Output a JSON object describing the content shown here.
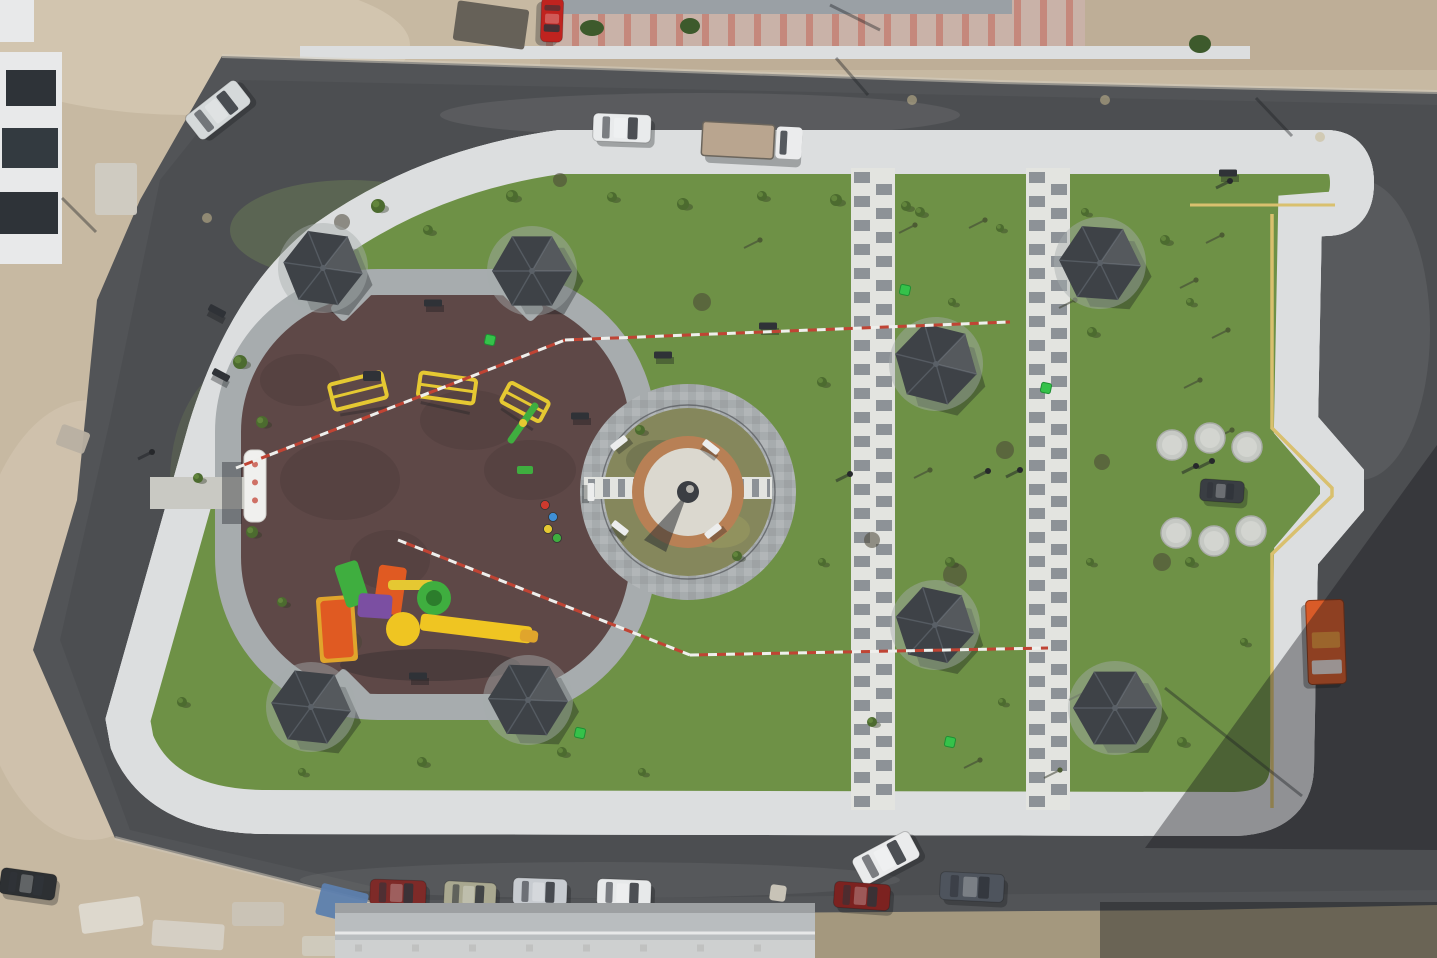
{
  "scene_title": "aerial-view-guitar-shaped-park",
  "palette": {
    "dirt": "#c7b9a2",
    "dirt_light": "#d9cdb8",
    "dirt_dark": "#b3a289",
    "scrub": "#b2a58b",
    "asphalt": "#525457",
    "asphalt_dark": "#434547",
    "asphalt_light": "#616365",
    "paver": "#a7acae",
    "paver_mid": "#96999c",
    "paver_light": "#c2c6c8",
    "kerb": "#dcdedf",
    "yellow_line": "#d9c06e",
    "grass": "#6e9146",
    "grass_dark": "#5a7c38",
    "grass_light": "#86a258",
    "grass_dry": "#9fa06b",
    "rubber": "#5e4847",
    "rubber_dark": "#4e3c3b",
    "neck_paver": "#83898d",
    "ladder_white": "#e3e4e0",
    "ladder_dark": "#8d9297",
    "gazebo_roof": "#3e4247",
    "gazebo_light": "#5a6067",
    "brick_ring": "#b88055",
    "plaza_white": "#dbd8cf",
    "ring_ground": "#85875c",
    "tape_red": "#c04434",
    "tape_white": "#efefec",
    "bin_green": "#35c24a",
    "concrete": "#c9c9c3",
    "eq_yellow": "#e5c832",
    "eq_green": "#3fae3f",
    "eq_orange": "#e05a22",
    "eq_purple": "#7b4fa2",
    "eq_red": "#cc3a2e",
    "eq_blue": "#3f8fd6",
    "truck_orange": "#d95b28"
  },
  "scene": {
    "gazebos": [
      {
        "x": 323,
        "y": 268,
        "r": 40,
        "rot": 8
      },
      {
        "x": 532,
        "y": 271,
        "r": 40,
        "rot": 0
      },
      {
        "x": 936,
        "y": 364,
        "r": 42,
        "rot": 14
      },
      {
        "x": 1100,
        "y": 263,
        "r": 41,
        "rot": 4
      },
      {
        "x": 311,
        "y": 707,
        "r": 40,
        "rot": 6
      },
      {
        "x": 528,
        "y": 700,
        "r": 40,
        "rot": 2
      },
      {
        "x": 935,
        "y": 625,
        "r": 40,
        "rot": 12
      },
      {
        "x": 1115,
        "y": 708,
        "r": 42,
        "rot": 0
      }
    ],
    "cars": [
      {
        "x": 218,
        "y": 110,
        "rot": -38,
        "w": 64,
        "h": 30,
        "c": "#d5d9da",
        "name": "silver-car-top-left"
      },
      {
        "x": 622,
        "y": 128,
        "rot": 2,
        "w": 58,
        "h": 28,
        "c": "#e9ebec",
        "name": "white-car-top-road"
      },
      {
        "x": 552,
        "y": 20,
        "rot": 92,
        "w": 44,
        "h": 22,
        "c": "#c0231f",
        "name": "red-car-building-lot"
      },
      {
        "x": 398,
        "y": 893,
        "rot": 2,
        "w": 56,
        "h": 26,
        "c": "#7e2a28",
        "name": "dark-red-car-bottom"
      },
      {
        "x": 470,
        "y": 895,
        "rot": 3,
        "w": 52,
        "h": 26,
        "c": "#a9a890",
        "name": "olive-car-bottom"
      },
      {
        "x": 540,
        "y": 892,
        "rot": 2,
        "w": 54,
        "h": 27,
        "c": "#c7cbd0",
        "name": "silver-car-bottom"
      },
      {
        "x": 624,
        "y": 893,
        "rot": 2,
        "w": 54,
        "h": 27,
        "c": "#e7e9ea",
        "name": "white-car-bottom"
      },
      {
        "x": 886,
        "y": 858,
        "rot": -28,
        "w": 64,
        "h": 30,
        "c": "#eaebec",
        "name": "white-van-bottom"
      },
      {
        "x": 862,
        "y": 896,
        "rot": 4,
        "w": 56,
        "h": 26,
        "c": "#7c2220",
        "name": "dark-red-car-bottom-2"
      },
      {
        "x": 972,
        "y": 887,
        "rot": 3,
        "w": 64,
        "h": 28,
        "c": "#4e545d",
        "name": "gray-suv-bottom"
      },
      {
        "x": 28,
        "y": 884,
        "rot": 8,
        "w": 56,
        "h": 26,
        "c": "#2d3033",
        "name": "black-car-bottom-left"
      },
      {
        "x": 1222,
        "y": 491,
        "rot": 4,
        "w": 44,
        "h": 22,
        "c": "#3a3e43",
        "name": "utility-cart-on-path"
      }
    ],
    "flatbed_truck": {
      "x": 752,
      "y": 141,
      "rot": 3,
      "bed": "#b9a58f",
      "cab": "#ebeced"
    },
    "orange_truck": {
      "x": 1326,
      "y": 642,
      "rot": 88,
      "w": 84,
      "h": 38
    },
    "people": [
      {
        "x": 1020,
        "y": 470
      },
      {
        "x": 1196,
        "y": 466
      },
      {
        "x": 1212,
        "y": 461
      },
      {
        "x": 850,
        "y": 474
      },
      {
        "x": 988,
        "y": 471
      },
      {
        "x": 152,
        "y": 452
      },
      {
        "x": 1230,
        "y": 181
      }
    ],
    "white_benches": [
      {
        "x": 619,
        "y": 443,
        "rot": -38
      },
      {
        "x": 711,
        "y": 447,
        "rot": 38
      },
      {
        "x": 620,
        "y": 528,
        "rot": 38
      },
      {
        "x": 713,
        "y": 531,
        "rot": -38
      },
      {
        "x": 591,
        "y": 492,
        "rot": 90
      }
    ],
    "dark_benches": [
      {
        "x": 433,
        "y": 303,
        "rot": 0
      },
      {
        "x": 217,
        "y": 311,
        "rot": 28
      },
      {
        "x": 221,
        "y": 375,
        "rot": 28
      },
      {
        "x": 418,
        "y": 676,
        "rot": 0
      },
      {
        "x": 1228,
        "y": 173,
        "rot": 0
      },
      {
        "x": 580,
        "y": 416,
        "rot": 0
      },
      {
        "x": 663,
        "y": 355,
        "rot": 0
      },
      {
        "x": 768,
        "y": 326,
        "rot": 0
      }
    ],
    "shrubs": [
      [
        378,
        206,
        7
      ],
      [
        428,
        230,
        5
      ],
      [
        512,
        196,
        6
      ],
      [
        612,
        197,
        5
      ],
      [
        683,
        204,
        6
      ],
      [
        762,
        196,
        5
      ],
      [
        836,
        200,
        6
      ],
      [
        906,
        206,
        5
      ],
      [
        240,
        362,
        7
      ],
      [
        262,
        422,
        6
      ],
      [
        252,
        532,
        6
      ],
      [
        282,
        602,
        5
      ],
      [
        198,
        478,
        5
      ],
      [
        920,
        212,
        5
      ],
      [
        1000,
        228,
        4
      ],
      [
        1085,
        212,
        4
      ],
      [
        1165,
        240,
        5
      ],
      [
        822,
        382,
        5
      ],
      [
        952,
        302,
        4
      ],
      [
        1092,
        332,
        5
      ],
      [
        1190,
        302,
        4
      ],
      [
        822,
        562,
        4
      ],
      [
        950,
        562,
        5
      ],
      [
        1090,
        562,
        4
      ],
      [
        1190,
        562,
        5
      ],
      [
        872,
        722,
        5
      ],
      [
        1002,
        702,
        4
      ],
      [
        1182,
        742,
        5
      ],
      [
        1244,
        642,
        4
      ],
      [
        562,
        752,
        5
      ],
      [
        642,
        772,
        4
      ],
      [
        422,
        762,
        5
      ],
      [
        302,
        772,
        4
      ],
      [
        182,
        702,
        5
      ],
      [
        640,
        430,
        5
      ],
      [
        737,
        556,
        5
      ]
    ],
    "saplings": [
      [
        915,
        225
      ],
      [
        985,
        220
      ],
      [
        1075,
        300
      ],
      [
        1222,
        235
      ],
      [
        1196,
        280
      ],
      [
        1228,
        330
      ],
      [
        1200,
        380
      ],
      [
        1232,
        430
      ],
      [
        760,
        240
      ],
      [
        930,
        470
      ],
      [
        1085,
        692
      ],
      [
        1135,
        695
      ],
      [
        980,
        760
      ],
      [
        1060,
        770
      ]
    ],
    "dry_patches": [
      [
        300,
        650,
        44,
        18
      ],
      [
        432,
        742,
        52,
        16
      ],
      [
        560,
        622,
        38,
        14
      ],
      [
        660,
        252,
        46,
        16
      ],
      [
        520,
        222,
        42,
        14
      ],
      [
        952,
        582,
        32,
        12
      ],
      [
        1082,
        642,
        38,
        12
      ],
      [
        882,
        702,
        32,
        12
      ],
      [
        350,
        250,
        36,
        12
      ],
      [
        760,
        600,
        40,
        14
      ],
      [
        1140,
        600,
        30,
        12
      ],
      [
        980,
        400,
        36,
        12
      ]
    ],
    "dark_patches": [
      [
        955,
        575,
        12
      ],
      [
        1005,
        450,
        9
      ],
      [
        872,
        540,
        8
      ],
      [
        702,
        302,
        9
      ],
      [
        352,
        642,
        10
      ],
      [
        1162,
        562,
        9
      ],
      [
        1102,
        462,
        8
      ],
      [
        342,
        222,
        8
      ],
      [
        560,
        180,
        7
      ]
    ],
    "grass_tones": [
      [
        430,
        620,
        130,
        60,
        "#5a7c38",
        0.22
      ],
      [
        350,
        230,
        120,
        50,
        "#86a258",
        0.28
      ],
      [
        900,
        600,
        160,
        70,
        "#5a7c38",
        0.18
      ],
      [
        1050,
        250,
        140,
        60,
        "#86a258",
        0.2
      ],
      [
        700,
        700,
        150,
        60,
        "#9fa06b",
        0.22
      ],
      [
        250,
        480,
        80,
        120,
        "#86a258",
        0.18
      ],
      [
        1150,
        480,
        60,
        100,
        "#9fa06b",
        0.18
      ],
      [
        600,
        200,
        140,
        40,
        "#9fa06b",
        0.18
      ]
    ],
    "rubber_blotches": [
      [
        340,
        480,
        60,
        40
      ],
      [
        470,
        420,
        50,
        30
      ],
      [
        390,
        560,
        40,
        30
      ],
      [
        300,
        380,
        40,
        26
      ],
      [
        530,
        470,
        46,
        30
      ]
    ],
    "bins": [
      [
        490,
        340
      ],
      [
        905,
        290
      ],
      [
        1046,
        388
      ],
      [
        580,
        733
      ],
      [
        950,
        742
      ]
    ],
    "discs": [
      [
        1172,
        445
      ],
      [
        1210,
        438
      ],
      [
        1247,
        447
      ],
      [
        1176,
        533
      ],
      [
        1214,
        541
      ],
      [
        1251,
        531
      ]
    ],
    "tapes": [
      [
        236,
        468,
        565,
        340
      ],
      [
        565,
        340,
        1010,
        322
      ],
      [
        398,
        540,
        690,
        655
      ],
      [
        690,
        655,
        1048,
        648
      ]
    ],
    "shadow_lines": [
      [
        868,
        95,
        836,
        58
      ],
      [
        1292,
        136,
        1256,
        98
      ],
      [
        1165,
        688,
        1302,
        796
      ],
      [
        96,
        232,
        62,
        198
      ],
      [
        880,
        30,
        830,
        5
      ]
    ],
    "road_dots": [
      [
        207,
        218
      ],
      [
        1105,
        100
      ],
      [
        1320,
        137
      ],
      [
        912,
        100
      ]
    ],
    "exercise_frames": [
      {
        "x": 358,
        "y": 391,
        "w": 54,
        "h": 26,
        "rot": -14
      },
      {
        "x": 447,
        "y": 388,
        "w": 56,
        "h": 24,
        "rot": 8
      },
      {
        "x": 525,
        "y": 402,
        "w": 44,
        "h": 22,
        "rot": 28
      }
    ],
    "seesaw": {
      "x": 523,
      "y": 423,
      "rot": -55
    },
    "green_bench": {
      "x": 525,
      "y": 470
    },
    "dark_mat": {
      "x": 372,
      "y": 376
    },
    "spring_riders": [
      [
        545,
        505,
        "#cc3a2e"
      ],
      [
        553,
        517,
        "#3f8fd6"
      ],
      [
        548,
        529,
        "#e5c832"
      ],
      [
        557,
        538,
        "#3fae3f"
      ]
    ],
    "play_structure": [
      {
        "t": "r",
        "x": 318,
        "y": 596,
        "w": 38,
        "h": 66,
        "rot": -4,
        "c": "#e0a52c"
      },
      {
        "t": "r",
        "x": 322,
        "y": 600,
        "w": 30,
        "h": 58,
        "rot": -4,
        "c": "#e05a22"
      },
      {
        "t": "r",
        "x": 340,
        "y": 562,
        "w": 24,
        "h": 44,
        "rot": -18,
        "c": "#3fae3f"
      },
      {
        "t": "r",
        "x": 376,
        "y": 566,
        "w": 28,
        "h": 48,
        "rot": 8,
        "c": "#e05a22"
      },
      {
        "t": "r",
        "x": 358,
        "y": 594,
        "w": 34,
        "h": 24,
        "rot": 4,
        "c": "#7b4fa2"
      },
      {
        "t": "r",
        "x": 388,
        "y": 580,
        "w": 46,
        "h": 10,
        "rot": 0,
        "c": "#e5c832"
      },
      {
        "t": "c",
        "x": 434,
        "y": 598,
        "r": 17,
        "c": "#3fae3f"
      },
      {
        "t": "c",
        "x": 434,
        "y": 598,
        "r": 8,
        "c": "#2c7d2c"
      },
      {
        "t": "c",
        "x": 403,
        "y": 629,
        "r": 17,
        "c": "#efc522"
      },
      {
        "t": "r",
        "x": 420,
        "y": 620,
        "w": 112,
        "h": 17,
        "rot": 7,
        "c": "#efc522"
      },
      {
        "t": "r",
        "x": 520,
        "y": 630,
        "w": 18,
        "h": 12,
        "rot": 7,
        "c": "#e0a52c"
      }
    ],
    "debris": [
      {
        "x": 318,
        "y": 888,
        "w": 48,
        "h": 32,
        "rot": 14,
        "c": "#5d7fae",
        "name": "blue-tarp"
      },
      {
        "x": 80,
        "y": 900,
        "w": 62,
        "h": 30,
        "rot": -8,
        "c": "#ded9d0",
        "name": "white-sacks"
      },
      {
        "x": 152,
        "y": 922,
        "w": 72,
        "h": 26,
        "rot": 4,
        "c": "#d6d0c6",
        "name": "rubble"
      },
      {
        "x": 232,
        "y": 902,
        "w": 52,
        "h": 24,
        "rot": 0,
        "c": "#cac3b7",
        "name": "rubble"
      },
      {
        "x": 302,
        "y": 936,
        "w": 62,
        "h": 20,
        "rot": 0,
        "c": "#d0cabe",
        "name": "rubble"
      },
      {
        "x": 390,
        "y": 915,
        "w": 40,
        "h": 26,
        "rot": 0,
        "c": "#c6bfb2",
        "name": "rubble"
      },
      {
        "x": 455,
        "y": 5,
        "w": 72,
        "h": 40,
        "rot": 8,
        "c": "#615c54",
        "name": "lumber-pile"
      },
      {
        "x": 95,
        "y": 163,
        "w": 42,
        "h": 52,
        "rot": 0,
        "c": "#d0cbc3",
        "name": "block-stack"
      },
      {
        "x": 58,
        "y": 428,
        "w": 30,
        "h": 22,
        "rot": 20,
        "c": "#b8b0a2",
        "name": "dirt-mound"
      },
      {
        "x": 770,
        "y": 885,
        "w": 16,
        "h": 16,
        "rot": 8,
        "c": "#cfc9bd",
        "name": "pallet-on-road"
      }
    ],
    "banner": {
      "x": 244,
      "y": 450,
      "w": 22,
      "h": 72
    }
  }
}
